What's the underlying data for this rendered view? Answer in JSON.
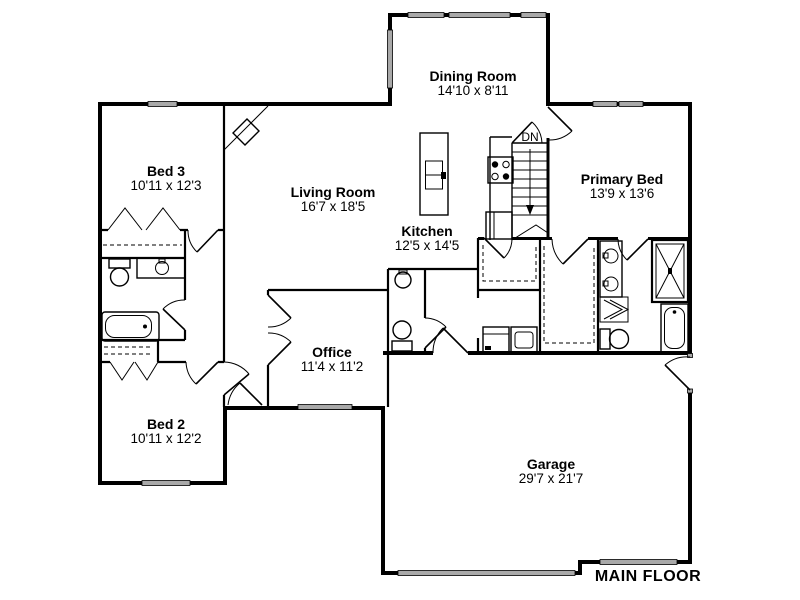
{
  "plan": {
    "title": "MAIN FLOOR",
    "stairs_label": "DN",
    "rooms": [
      {
        "name": "Bed 3",
        "dims": "10'11 x 12'3"
      },
      {
        "name": "Living Room",
        "dims": "16'7 x 18'5"
      },
      {
        "name": "Dining Room",
        "dims": "14'10 x 8'11"
      },
      {
        "name": "Kitchen",
        "dims": "12'5 x 14'5"
      },
      {
        "name": "Primary Bed",
        "dims": "13'9 x 13'6"
      },
      {
        "name": "Office",
        "dims": "11'4 x 11'2"
      },
      {
        "name": "Bed 2",
        "dims": "10'11 x 12'2"
      },
      {
        "name": "Garage",
        "dims": "29'7 x 21'7"
      }
    ],
    "colors": {
      "wall": "#000000",
      "window_fill": "#a9a9a9",
      "background": "#ffffff"
    }
  }
}
